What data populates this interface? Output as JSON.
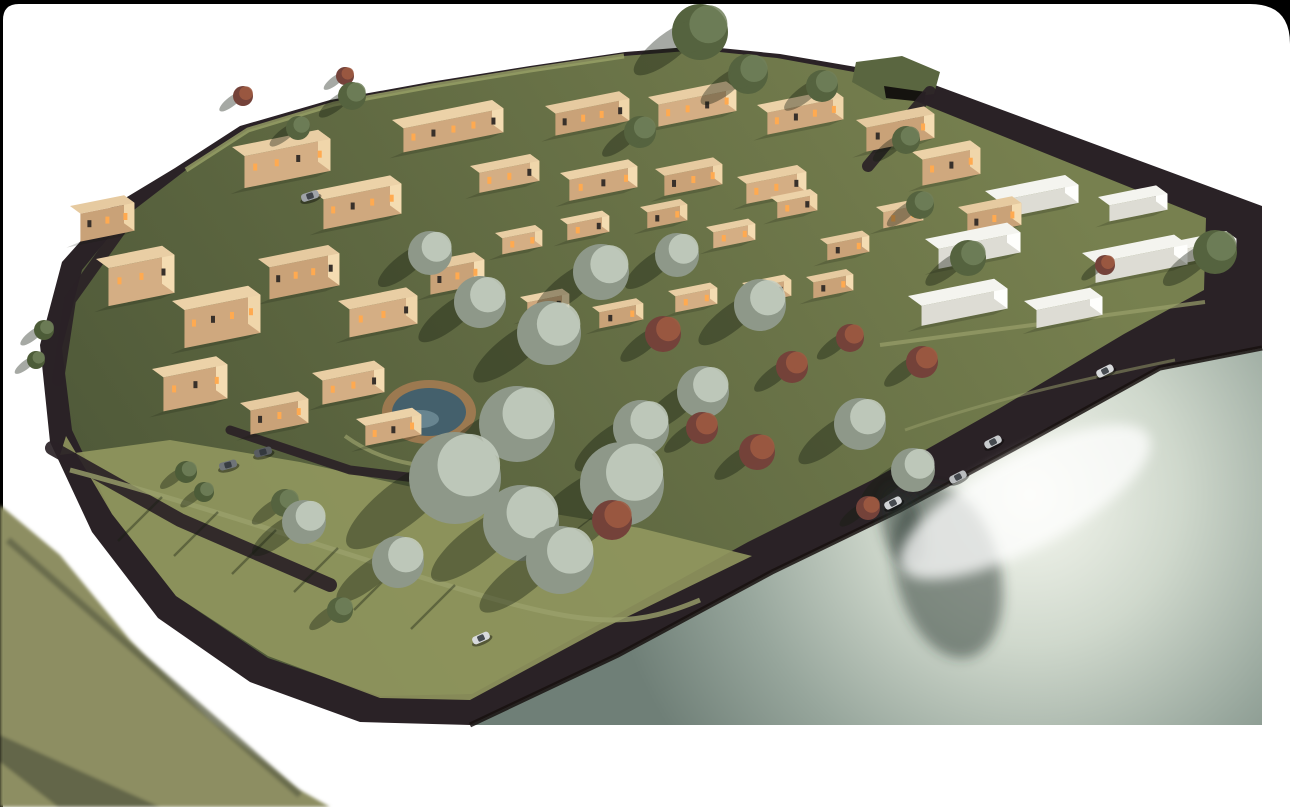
{
  "page": {
    "width": 1290,
    "height": 807,
    "background": "#000000",
    "canvas_color": "#ffffff",
    "canvas_path": "M 3,20 Q 3,4 19,4 L 1250,4 Q 1290,4 1290,44 L 1290,807 L 3,807 Z"
  },
  "colors": {
    "road_dark": "#2a2226",
    "road_edge": "#17110f",
    "grass_light": "#939860",
    "grass_mid": "#77804f",
    "grass_dark": "#4e5838",
    "rim_light": "#9aa368",
    "water_bright": "#f6f8f0",
    "water_mid1": "#cfd8cc",
    "water_mid2": "#97a69c",
    "water_dark": "#6f7f77",
    "glare": "#ffffff",
    "reflection": "rgba(42,58,48,0.5)",
    "roof_shades": [
      "#ecd2a8",
      "#e6caa0",
      "#e9cea4"
    ],
    "front_shades": [
      "#cfa87e",
      "#c9a278",
      "#d4ae84"
    ],
    "end_shades": [
      "#f4dcb2",
      "#f0d6aa"
    ],
    "window_lit": "#ffaa50",
    "window_dark": "#38302a",
    "white_top": "#f4f4ef",
    "white_front": "#dddcd4",
    "white_end": "#fefefc",
    "tree_olive_base": "#8e9889",
    "tree_olive_hi": "#c6cfc2",
    "tree_green_base": "#55633f",
    "tree_green_hi": "#71805a",
    "tree_red_base": "#74423a",
    "tree_red_hi": "#a05b42",
    "tree_palm": "#4d5c38",
    "trunk": "#4a3a2a",
    "shadow": "rgba(22,28,16,0.38)",
    "pool_deck": "#9c7950",
    "pool_water": "#44606c",
    "pool_hi": "#7795a0",
    "berm_grass": "#5a6640",
    "berm_opening": "#15130f",
    "path_light": "#9aa06b",
    "wedge_main": "#8d8e62",
    "wedge_stripe": "#65684426",
    "wedge_dark": "#63664a",
    "car_shadow": "rgba(0,0,0,0.4)",
    "car_glass": "#2e3338"
  },
  "terrain": {
    "site_outline": [
      [
        175,
        168
      ],
      [
        240,
        126
      ],
      [
        330,
        100
      ],
      [
        430,
        82
      ],
      [
        530,
        66
      ],
      [
        625,
        52
      ],
      [
        700,
        46
      ],
      [
        780,
        54
      ],
      [
        862,
        68
      ],
      [
        932,
        84
      ],
      [
        1262,
        206
      ],
      [
        1262,
        348
      ],
      [
        1160,
        368
      ],
      [
        1030,
        440
      ],
      [
        900,
        510
      ],
      [
        772,
        572
      ],
      [
        618,
        655
      ],
      [
        470,
        725
      ],
      [
        360,
        722
      ],
      [
        250,
        682
      ],
      [
        158,
        618
      ],
      [
        92,
        532
      ],
      [
        50,
        442
      ],
      [
        40,
        345
      ],
      [
        62,
        262
      ],
      [
        112,
        206
      ]
    ],
    "grass_inset": [
      [
        186,
        170
      ],
      [
        248,
        130
      ],
      [
        334,
        104
      ],
      [
        432,
        86
      ],
      [
        530,
        70
      ],
      [
        624,
        56
      ],
      [
        700,
        50
      ],
      [
        777,
        58
      ],
      [
        854,
        72
      ],
      [
        908,
        98
      ],
      [
        1206,
        218
      ],
      [
        1204,
        290
      ],
      [
        1124,
        334
      ],
      [
        1000,
        408
      ],
      [
        872,
        480
      ],
      [
        748,
        542
      ],
      [
        596,
        626
      ],
      [
        472,
        694
      ],
      [
        380,
        696
      ],
      [
        268,
        658
      ],
      [
        176,
        596
      ],
      [
        112,
        514
      ],
      [
        72,
        430
      ],
      [
        62,
        348
      ],
      [
        82,
        270
      ],
      [
        126,
        216
      ]
    ],
    "park_overlay": [
      [
        66,
        436
      ],
      [
        60,
        455
      ],
      [
        170,
        440
      ],
      [
        300,
        462
      ],
      [
        470,
        500
      ],
      [
        640,
        528
      ],
      [
        752,
        556
      ],
      [
        600,
        630
      ],
      [
        470,
        700
      ],
      [
        380,
        698
      ],
      [
        268,
        656
      ],
      [
        176,
        596
      ],
      [
        112,
        514
      ]
    ],
    "rim_points": [
      [
        186,
        170
      ],
      [
        248,
        130
      ],
      [
        334,
        104
      ],
      [
        432,
        86
      ],
      [
        530,
        70
      ],
      [
        624,
        56
      ]
    ],
    "berm": [
      [
        856,
        62
      ],
      [
        902,
        56
      ],
      [
        940,
        72
      ],
      [
        934,
        94
      ],
      [
        884,
        100
      ],
      [
        852,
        82
      ]
    ],
    "berm_opening": [
      [
        884,
        86
      ],
      [
        926,
        92
      ],
      [
        924,
        102
      ],
      [
        886,
        98
      ]
    ]
  },
  "roads": {
    "internal": [
      {
        "pts": [
          [
            52,
            448
          ],
          [
            180,
            520
          ],
          [
            330,
            585
          ]
        ],
        "w": 14
      },
      {
        "pts": [
          [
            930,
            92
          ],
          [
            898,
            130
          ],
          [
            868,
            166
          ]
        ],
        "w": 12
      },
      {
        "pts": [
          [
            120,
            230
          ],
          [
            70,
            300
          ],
          [
            58,
            380
          ]
        ],
        "w": 12
      },
      {
        "pts": [
          [
            230,
            430
          ],
          [
            350,
            470
          ],
          [
            432,
            480
          ]
        ],
        "w": 9
      }
    ],
    "paths": [
      {
        "d": "M 70,470 C 220,510 360,560 480,595 S 640,625 700,600",
        "w": 5,
        "o": 0.8
      },
      {
        "d": "M 880,345 C 1000,330 1080,318 1205,302",
        "w": 4,
        "o": 0.7
      },
      {
        "d": "M 905,430 C 990,400 1080,380 1175,360",
        "w": 3,
        "o": 0.5
      },
      {
        "d": "M 345,436 C 385,465 435,472 478,462",
        "w": 4,
        "o": 0.7
      }
    ],
    "pole_shadows": [
      [
        162,
        497,
        118,
        541
      ],
      [
        218,
        512,
        174,
        556
      ],
      [
        276,
        530,
        232,
        574
      ],
      [
        338,
        548,
        294,
        592
      ],
      [
        398,
        566,
        354,
        610
      ],
      [
        455,
        585,
        411,
        629
      ]
    ]
  },
  "water": {
    "outline": [
      [
        1262,
        348
      ],
      [
        1160,
        368
      ],
      [
        1030,
        440
      ],
      [
        900,
        510
      ],
      [
        772,
        572
      ],
      [
        618,
        655
      ],
      [
        470,
        725
      ],
      [
        1262,
        725
      ]
    ],
    "gradient_center": [
      1030,
      495
    ],
    "gradient_radius": 430,
    "glare": {
      "cx": 1025,
      "cy": 502,
      "rx": 140,
      "ry": 46,
      "rot": -28,
      "opacity": 0.75
    },
    "reflections": [
      {
        "cx": 948,
        "cy": 572,
        "rx": 52,
        "ry": 88,
        "rot": -14
      },
      {
        "cx": 902,
        "cy": 526,
        "rx": 20,
        "ry": 42,
        "rot": -14
      }
    ]
  },
  "pool": {
    "cx": 429,
    "cy": 412,
    "deck_rx": 47,
    "deck_ry": 32,
    "water_rx": 37,
    "water_ry": 24,
    "hi_cx": 420,
    "hi_cy": 419,
    "hi_rx": 19,
    "hi_ry": 9
  },
  "buildings": {
    "tan": [
      [
        392,
        120,
        100,
        22,
        24
      ],
      [
        545,
        106,
        74,
        20,
        22
      ],
      [
        648,
        97,
        78,
        20,
        22
      ],
      [
        757,
        105,
        76,
        20,
        22
      ],
      [
        856,
        120,
        68,
        20,
        24
      ],
      [
        470,
        166,
        60,
        18,
        20
      ],
      [
        560,
        173,
        68,
        18,
        21
      ],
      [
        655,
        169,
        58,
        18,
        20
      ],
      [
        737,
        177,
        60,
        18,
        20
      ],
      [
        912,
        152,
        58,
        20,
        26
      ],
      [
        958,
        207,
        54,
        18,
        22
      ],
      [
        495,
        233,
        40,
        14,
        16
      ],
      [
        560,
        219,
        42,
        14,
        16
      ],
      [
        640,
        207,
        40,
        14,
        16
      ],
      [
        706,
        227,
        42,
        14,
        16
      ],
      [
        770,
        197,
        40,
        14,
        16
      ],
      [
        820,
        239,
        42,
        14,
        16
      ],
      [
        876,
        207,
        40,
        14,
        16
      ],
      [
        520,
        297,
        42,
        14,
        16
      ],
      [
        592,
        307,
        44,
        14,
        16
      ],
      [
        668,
        291,
        42,
        14,
        16
      ],
      [
        742,
        283,
        42,
        14,
        16
      ],
      [
        806,
        277,
        40,
        14,
        16
      ],
      [
        232,
        147,
        86,
        24,
        32
      ],
      [
        312,
        191,
        78,
        22,
        30
      ],
      [
        70,
        206,
        54,
        20,
        28
      ],
      [
        96,
        259,
        66,
        24,
        38
      ],
      [
        172,
        301,
        76,
        24,
        38
      ],
      [
        258,
        259,
        70,
        22,
        32
      ],
      [
        338,
        301,
        68,
        22,
        28
      ],
      [
        152,
        369,
        64,
        22,
        34
      ],
      [
        240,
        403,
        58,
        20,
        24
      ],
      [
        312,
        373,
        62,
        20,
        24
      ],
      [
        356,
        419,
        56,
        18,
        20
      ],
      [
        420,
        263,
        54,
        20,
        24
      ]
    ],
    "white": [
      [
        985,
        191,
        80,
        26,
        18
      ],
      [
        1098,
        197,
        58,
        22,
        16
      ],
      [
        925,
        239,
        82,
        26,
        20
      ],
      [
        1082,
        253,
        92,
        26,
        20
      ],
      [
        1176,
        241,
        50,
        20,
        14
      ],
      [
        908,
        296,
        86,
        26,
        20
      ],
      [
        1024,
        301,
        66,
        24,
        18
      ]
    ],
    "slope": 0.2,
    "depth_dx": 0.52,
    "depth_dy": 0.38
  },
  "trees": [
    [
      455,
      478,
      46,
      "olive"
    ],
    [
      517,
      424,
      38,
      "olive"
    ],
    [
      549,
      333,
      32,
      "olive"
    ],
    [
      601,
      272,
      28,
      "olive"
    ],
    [
      622,
      484,
      42,
      "olive"
    ],
    [
      560,
      560,
      34,
      "olive"
    ],
    [
      521,
      523,
      38,
      "olive"
    ],
    [
      480,
      302,
      26,
      "olive"
    ],
    [
      430,
      253,
      22,
      "olive"
    ],
    [
      641,
      428,
      28,
      "olive"
    ],
    [
      703,
      392,
      26,
      "olive"
    ],
    [
      760,
      305,
      26,
      "olive"
    ],
    [
      860,
      424,
      26,
      "olive"
    ],
    [
      913,
      470,
      22,
      "olive"
    ],
    [
      398,
      562,
      26,
      "olive"
    ],
    [
      304,
      522,
      22,
      "olive"
    ],
    [
      677,
      255,
      22,
      "olive"
    ],
    [
      700,
      32,
      28,
      "green"
    ],
    [
      748,
      74,
      20,
      "green"
    ],
    [
      640,
      132,
      16,
      "green"
    ],
    [
      822,
      86,
      16,
      "green"
    ],
    [
      352,
      96,
      14,
      "green"
    ],
    [
      906,
      140,
      14,
      "green"
    ],
    [
      968,
      258,
      18,
      "green"
    ],
    [
      920,
      205,
      14,
      "green"
    ],
    [
      1215,
      252,
      22,
      "green"
    ],
    [
      298,
      128,
      12,
      "green"
    ],
    [
      285,
      503,
      14,
      "green"
    ],
    [
      340,
      610,
      13,
      "green"
    ],
    [
      612,
      520,
      20,
      "red"
    ],
    [
      663,
      334,
      18,
      "red"
    ],
    [
      702,
      428,
      16,
      "red"
    ],
    [
      757,
      452,
      18,
      "red"
    ],
    [
      792,
      367,
      16,
      "red"
    ],
    [
      850,
      338,
      14,
      "red"
    ],
    [
      922,
      362,
      16,
      "red"
    ],
    [
      868,
      508,
      12,
      "red"
    ],
    [
      243,
      96,
      10,
      "red"
    ],
    [
      345,
      76,
      9,
      "red"
    ],
    [
      1105,
      265,
      10,
      "red"
    ],
    [
      186,
      472,
      11,
      "palm"
    ],
    [
      204,
      492,
      10,
      "palm"
    ],
    [
      44,
      330,
      10,
      "palm"
    ],
    [
      36,
      360,
      9,
      "palm"
    ]
  ],
  "cars": [
    [
      1105,
      371,
      -27,
      "#d8dadc"
    ],
    [
      993,
      442,
      -27,
      "#c9ccce"
    ],
    [
      958,
      477,
      -27,
      "#b9bcbe"
    ],
    [
      893,
      503,
      -27,
      "#d2d4d6"
    ],
    [
      481,
      638,
      -24,
      "#d8dadc"
    ],
    [
      310,
      196,
      -18,
      "#9fa3a8"
    ],
    [
      228,
      465,
      -15,
      "#6f7478"
    ],
    [
      263,
      452,
      -15,
      "#585c60"
    ]
  ],
  "foreground": {
    "wedge": [
      [
        0,
        505
      ],
      [
        60,
        555
      ],
      [
        130,
        640
      ],
      [
        210,
        720
      ],
      [
        300,
        790
      ],
      [
        330,
        807
      ],
      [
        0,
        807
      ]
    ],
    "stripe": [
      [
        0,
        735
      ],
      [
        160,
        807
      ],
      [
        58,
        807
      ],
      [
        0,
        762
      ]
    ],
    "edge_line": [
      [
        8,
        540
      ],
      [
        300,
        795
      ]
    ]
  }
}
